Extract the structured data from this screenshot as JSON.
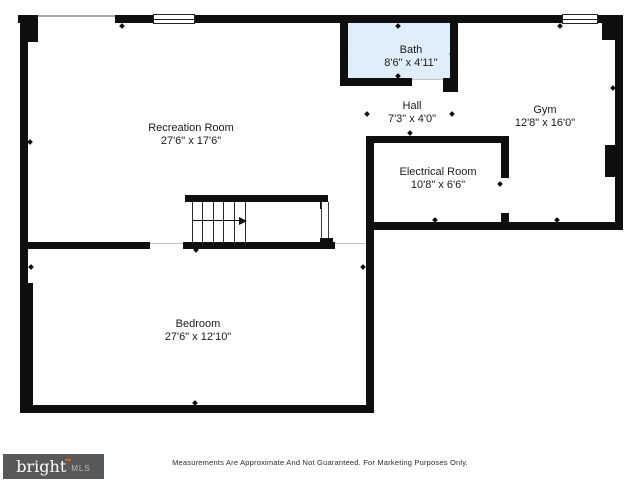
{
  "plan": {
    "level_type": "basement-floorplan",
    "rooms": [
      {
        "id": "recreation",
        "name": "Recreation Room",
        "dims": "27'6\" x 17'6\""
      },
      {
        "id": "bath",
        "name": "Bath",
        "dims": "8'6\" x 4'11\""
      },
      {
        "id": "hall",
        "name": "Hall",
        "dims": "7'3\" x 4'0\""
      },
      {
        "id": "gym",
        "name": "Gym",
        "dims": "12'8\" x 16'0\""
      },
      {
        "id": "electrical",
        "name": "Electrical Room",
        "dims": "10'8\" x 6'6\""
      },
      {
        "id": "bedroom",
        "name": "Bedroom",
        "dims": "27'6\" x 12'10\""
      }
    ]
  },
  "footer": {
    "disclaimer": "Measurements Are Approximate And Not Guaranteed. For Marketing Purposes Only.",
    "logo": {
      "brand": "bright",
      "suffix": "MLS"
    }
  },
  "colors": {
    "wall": "#0f0f0f",
    "bath_fill": "#e0eef9",
    "logo_background": "#58595b",
    "logo_accent": "#d95f2b",
    "logo_brand_text": "#ffffff",
    "logo_suffix_text": "#b7b8ba"
  }
}
